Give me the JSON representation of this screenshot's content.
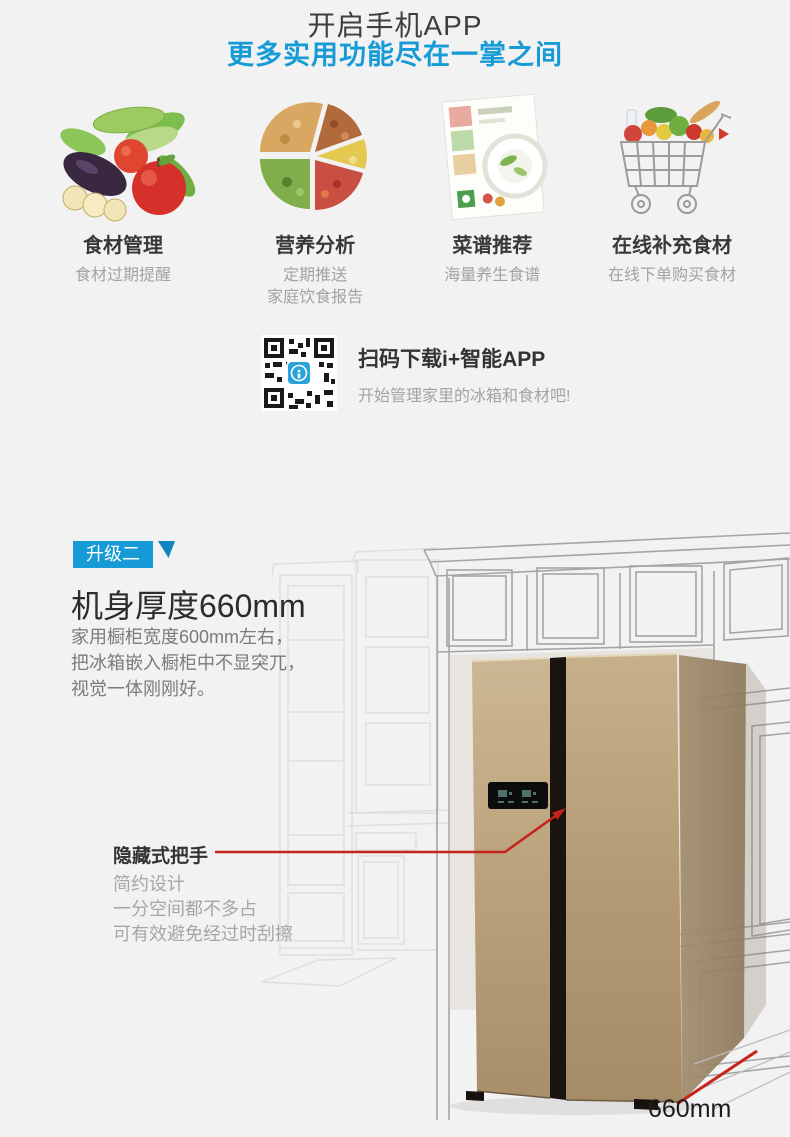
{
  "page": {
    "bg_color": "#f2f2f2",
    "accent_blue": "#169bd7",
    "accent_red": "#c5231b",
    "fridge_gold": "#b89e78"
  },
  "header": {
    "title": "开启手机APP",
    "subtitle": "更多实用功能尽在一掌之间"
  },
  "features": [
    {
      "icon": "fresh-produce",
      "title": "食材管理",
      "desc_lines": [
        "食材过期提醒"
      ]
    },
    {
      "icon": "nutrition-pie",
      "title": "营养分析",
      "desc_lines": [
        "定期推送",
        "家庭饮食报告"
      ]
    },
    {
      "icon": "recipe-book",
      "title": "菜谱推荐",
      "desc_lines": [
        "海量养生食谱"
      ]
    },
    {
      "icon": "grocery-cart",
      "title": "在线补充食材",
      "desc_lines": [
        "在线下单购买食材"
      ]
    }
  ],
  "qr": {
    "icon": "qr-code-with-app-logo",
    "title": "扫码下载i+智能APP",
    "subtitle": "开始管理家里的冰箱和食材吧!"
  },
  "upgrade": {
    "badge": "升级二",
    "heading": "机身厚度660mm",
    "body_lines": [
      "家用橱柜宽度600mm左右，",
      "把冰箱嵌入橱柜中不显突兀，",
      "视觉一体刚刚好。"
    ],
    "callout": {
      "label": "隐藏式把手",
      "lines": [
        "简约设计",
        "一分空间都不多占",
        "可有效避免经过时刮擦"
      ]
    },
    "dimension_label": "660mm"
  }
}
